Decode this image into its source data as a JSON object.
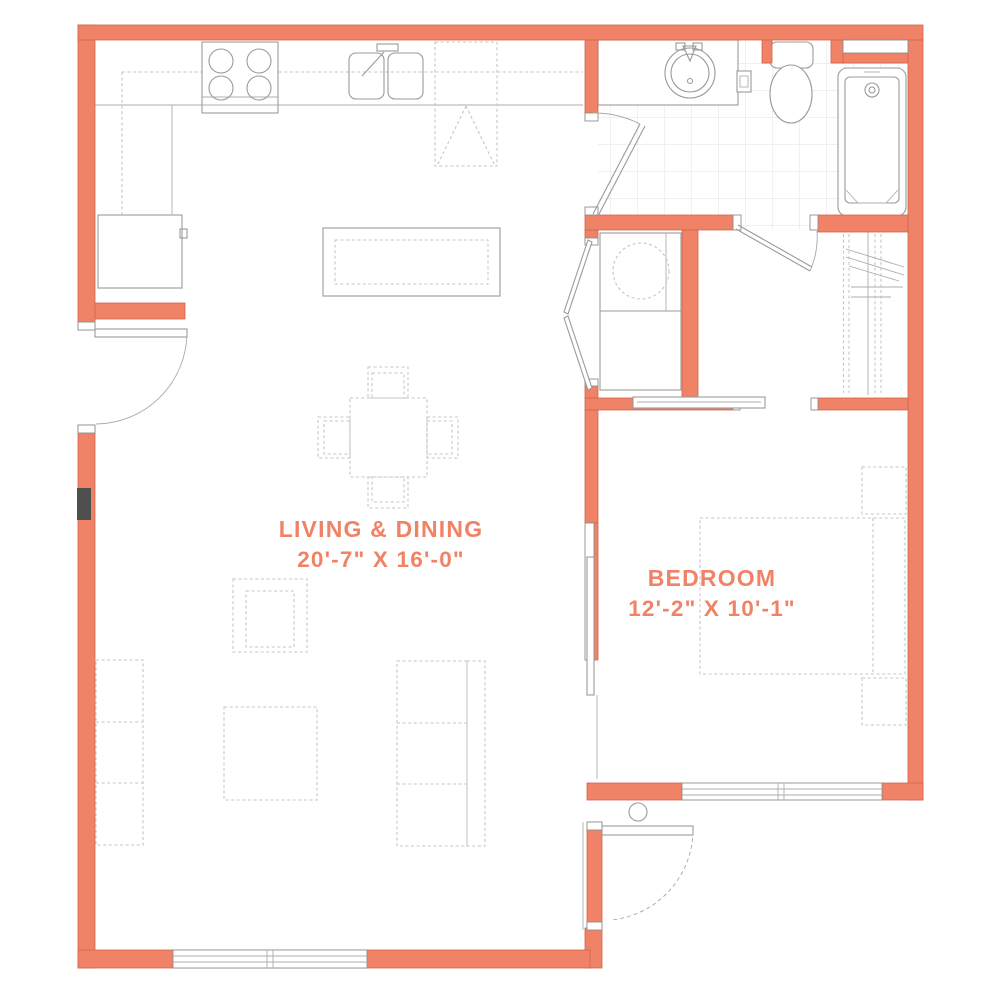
{
  "plan": {
    "title": "one-bedroom apartment floor plan",
    "rooms": [
      {
        "id": "living_dining",
        "label": "LIVING & DINING",
        "dimensions": "20'-7\" X 16'-0\""
      },
      {
        "id": "bedroom",
        "label": "BEDROOM",
        "dimensions": "12'-2\" X 10'-1\""
      }
    ],
    "unlabeled_areas": [
      "kitchen",
      "bathroom",
      "laundry-closet",
      "walk-in-closet",
      "entry-vestibule"
    ],
    "fixtures": [
      "range-4-burner",
      "double-bowl-sink",
      "dishwasher",
      "refrigerator",
      "kitchen-island",
      "vanity-round-sink",
      "toilet",
      "bathtub",
      "tub-shelf",
      "stacked-washer-dryer",
      "closet-rods-and-shelves",
      "closet-shelf",
      "dining-table-with-4-chairs",
      "armchair",
      "ottoman",
      "sofa",
      "console",
      "bed",
      "nightstand",
      "nightstand",
      "entry-door",
      "bedroom-pocket-door",
      "bathroom-door",
      "closet-door",
      "bifold-doors",
      "window",
      "window",
      "window",
      "electrical-panel"
    ]
  },
  "colors": {
    "wall": "#ef8267",
    "wall-edge": "#d2664e",
    "label": "#f08266",
    "line": "#9a9a9a",
    "thin": "#adadad",
    "dash": "#c6c6c6",
    "tile": "#e0e0e0",
    "panel": "#4f4f4f",
    "bg": "#ffffff"
  }
}
